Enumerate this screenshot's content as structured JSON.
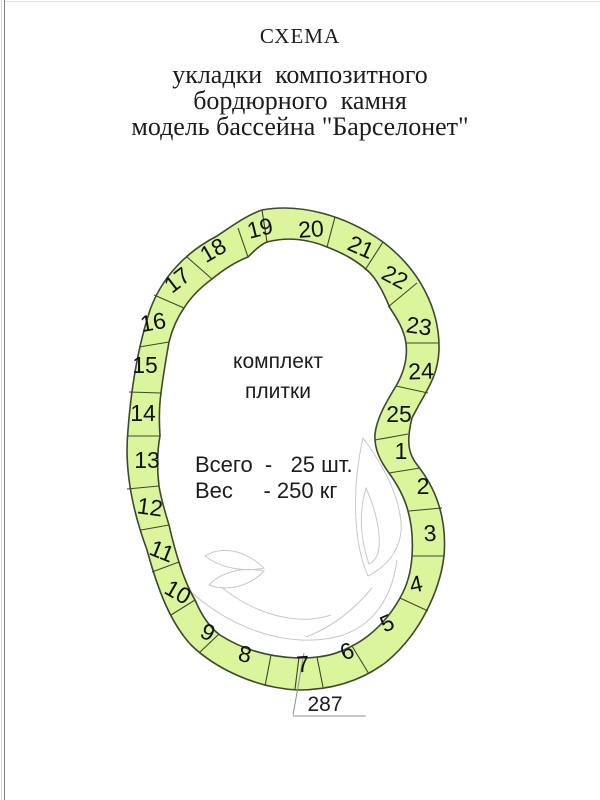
{
  "header": {
    "title": "СХЕМА",
    "subtitle_lines": [
      "укладки  композитного",
      "бордюрного  камня",
      "модель бассейна \"Барселонет\""
    ]
  },
  "diagram": {
    "center_label": {
      "line1": "комплект",
      "line2": "плитки"
    },
    "stats": {
      "line1": "Всего  -   25 шт.",
      "line2": "Вес     - 250 кг"
    },
    "dimension": "287",
    "segment_numbers": [
      "1",
      "2",
      "3",
      "4",
      "5",
      "6",
      "7",
      "8",
      "9",
      "10",
      "11",
      "12",
      "13",
      "14",
      "15",
      "16",
      "17",
      "18",
      "19",
      "20",
      "21",
      "22",
      "23",
      "24",
      "25"
    ],
    "colors": {
      "tile_fill": "#daf59c",
      "tile_outline": "#3f472f",
      "number_text": "#111111",
      "body_text": "#1c1c1c",
      "decoration_stroke": "#c8c8c8",
      "dimension_line": "#909090"
    }
  }
}
